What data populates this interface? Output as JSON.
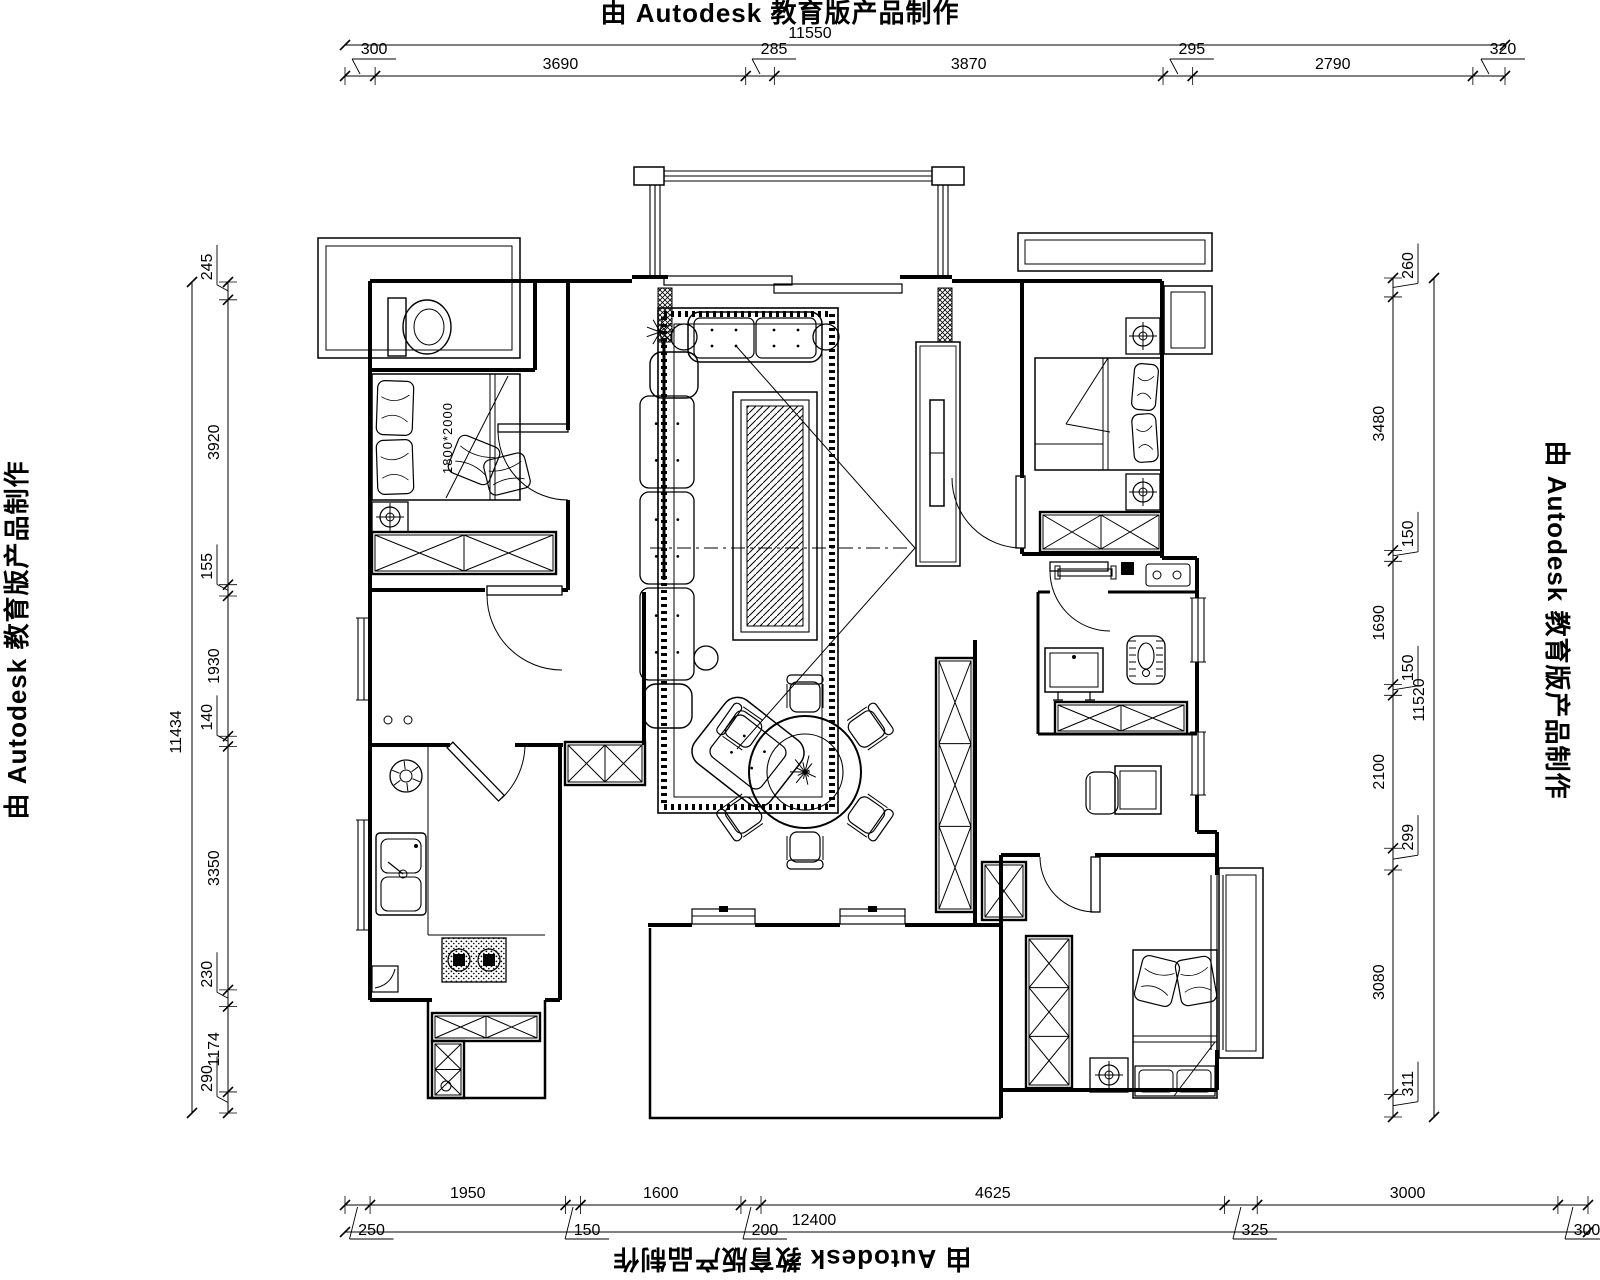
{
  "watermark": {
    "top": "由 Autodesk 教育版产品制作",
    "bottom": "由 Autodesk 教育版产品制作",
    "left": "由 Autodesk 教育版产品制作",
    "right": "由 Autodesk 教育版产品制作"
  },
  "dimensions": {
    "top": {
      "total": "11550",
      "segments": [
        "300",
        "3690",
        "285",
        "3870",
        "295",
        "2790",
        "320"
      ]
    },
    "bottom": {
      "total": "12400",
      "segments": [
        "250",
        "1950",
        "150",
        "1600",
        "200",
        "4625",
        "325",
        "3000",
        "300"
      ]
    },
    "left": {
      "total": "11434",
      "segments": [
        "245",
        "3920",
        "155",
        "1930",
        "140",
        "3350",
        "230",
        "1174",
        "290"
      ]
    },
    "right": {
      "total": "11520",
      "segments": [
        "260",
        "3480",
        "150",
        "1690",
        "150",
        "2100",
        "299",
        "3080",
        "311"
      ]
    }
  },
  "labels": {
    "bed_size": "1800*2000"
  },
  "colors": {
    "line": "#000000",
    "background": "#ffffff"
  }
}
